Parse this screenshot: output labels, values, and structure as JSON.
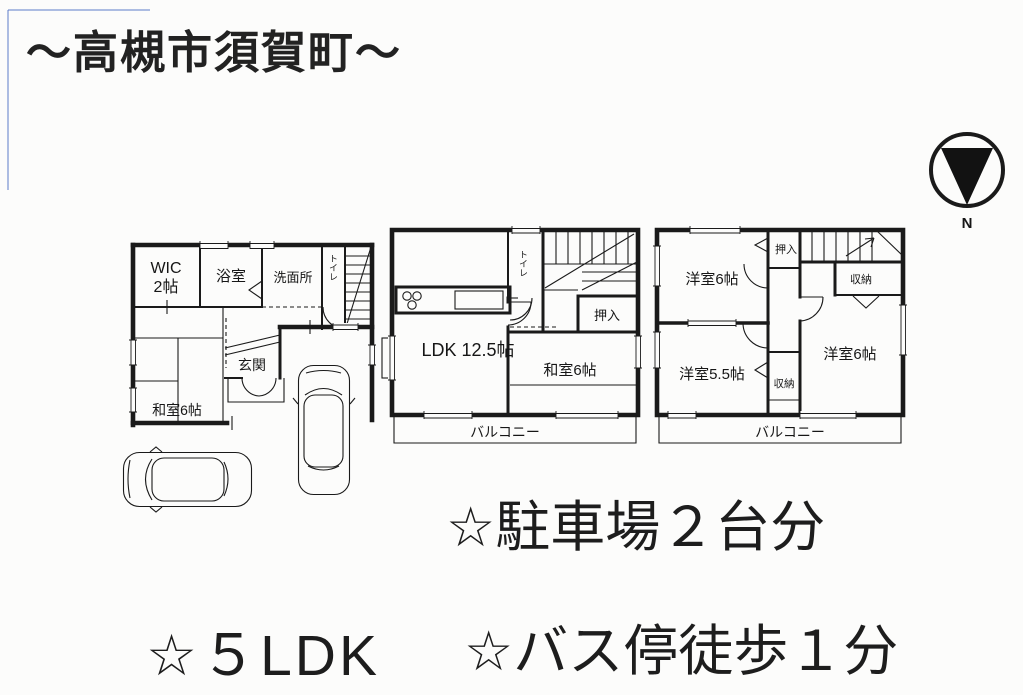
{
  "title": "～高槻市須賀町～",
  "compass": {
    "north": "N"
  },
  "floor1": {
    "wic1": "WIC",
    "wic2": "2帖",
    "bath": "浴室",
    "washroom": "洗面所",
    "toilet": "トイレ",
    "entrance": "玄関",
    "japanese_room": "和室6帖"
  },
  "floor2": {
    "ldk": "LDK 12.5帖",
    "toilet": "トイレ",
    "closet": "押入",
    "japanese_room": "和室6帖",
    "balcony": "バルコニー"
  },
  "floor3": {
    "western_nw": "洋室6帖",
    "closet": "押入",
    "storage_ne": "収納",
    "western_e": "洋室6帖",
    "western_sw": "洋室5.5帖",
    "storage_s": "収納",
    "balcony": "バルコニー"
  },
  "features": {
    "parking": "☆駐車場２台分",
    "layout": "☆５LDK",
    "bus": "☆バス停徒歩１分"
  },
  "colors": {
    "ink": "#1a1a1a",
    "scan_edge": "#5b79c9"
  }
}
